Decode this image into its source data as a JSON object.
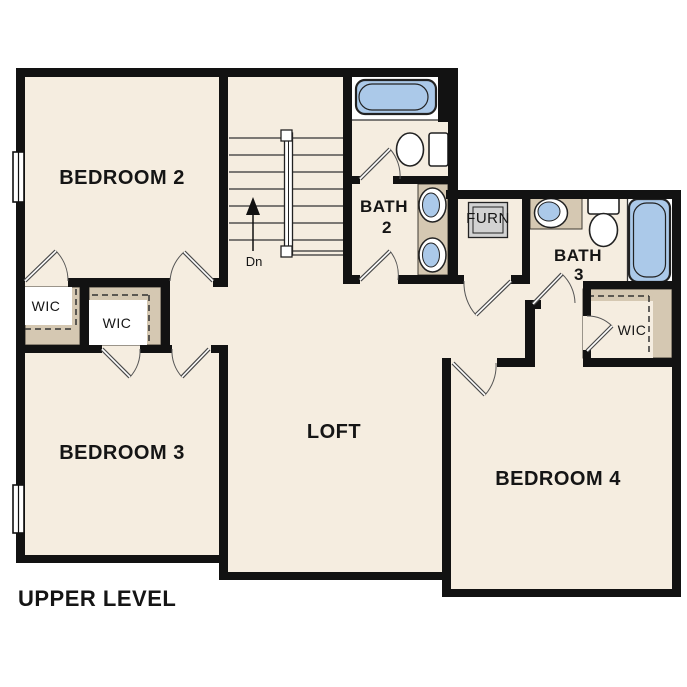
{
  "plan_title": "UPPER LEVEL",
  "labels": {
    "bedroom2": "BEDROOM 2",
    "bedroom3": "BEDROOM 3",
    "bedroom4": "BEDROOM 4",
    "loft": "LOFT",
    "bath2_name": "BATH",
    "bath2_num": "2",
    "bath3_name": "BATH",
    "bath3_num": "3",
    "closet": "WIC",
    "furnace": "FURN",
    "stair_direction": "Dn"
  },
  "colors": {
    "background": "#ffffff",
    "floor": "#f5ede0",
    "wall": "#121212",
    "cabinet_tan": "#d5c8b2",
    "fixture_blue": "#abc9e9",
    "fixture_outline": "#222222",
    "furnace_gray": "#d2d2d2"
  }
}
